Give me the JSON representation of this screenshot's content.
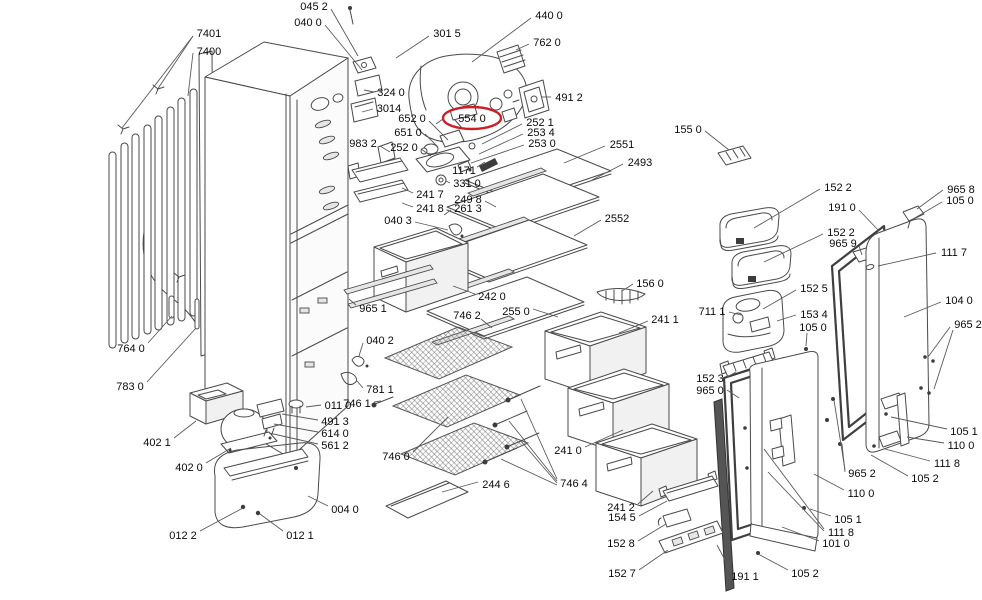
{
  "diagram": {
    "type": "exploded-parts-diagram",
    "background": "#ffffff",
    "line_color": "#4a4a4a",
    "text_color": "#0a0a0a",
    "highlight_color": "#cc2027",
    "selected_part": "554 0",
    "highlight_rx": 29,
    "highlight_ry": 11,
    "labels": [
      {
        "text": "7401",
        "x": 209,
        "y": 33,
        "leaders": [
          [
            193,
            36,
            157,
            90
          ],
          [
            193,
            36,
            122,
            128
          ]
        ]
      },
      {
        "text": "7400",
        "x": 209,
        "y": 51,
        "leaders": [
          [
            193,
            53,
            188,
            96
          ]
        ]
      },
      {
        "text": "045 2",
        "x": 314,
        "y": 6,
        "leaders": [
          [
            331,
            9,
            358,
            56
          ]
        ]
      },
      {
        "text": "040 0",
        "x": 308,
        "y": 22,
        "leaders": [
          [
            325,
            25,
            362,
            70
          ]
        ]
      },
      {
        "text": "301 5",
        "x": 447,
        "y": 33,
        "leaders": [
          [
            429,
            36,
            396,
            58
          ]
        ]
      },
      {
        "text": "440 0",
        "x": 549,
        "y": 15,
        "leaders": [
          [
            531,
            18,
            472,
            62
          ]
        ]
      },
      {
        "text": "762 0",
        "x": 547,
        "y": 42,
        "leaders": [
          [
            529,
            44,
            516,
            50
          ]
        ]
      },
      {
        "text": "324 0",
        "x": 391,
        "y": 92,
        "leaders": [
          [
            374,
            92,
            364,
            90
          ]
        ]
      },
      {
        "text": "3014",
        "x": 389,
        "y": 108,
        "leaders": [
          [
            373,
            109,
            362,
            112
          ]
        ]
      },
      {
        "text": "491 2",
        "x": 569,
        "y": 97,
        "leaders": [
          [
            551,
            97,
            542,
            97
          ]
        ]
      },
      {
        "text": "554 0",
        "x": 472,
        "y": 118,
        "highlight": true,
        "leaders": [
          [
            443,
            119,
            436,
            124
          ]
        ]
      },
      {
        "text": "652 0",
        "x": 412,
        "y": 118,
        "leaders": [
          [
            429,
            121,
            448,
            140
          ]
        ]
      },
      {
        "text": "651 0",
        "x": 408,
        "y": 132,
        "leaders": [
          [
            425,
            134,
            438,
            147
          ]
        ]
      },
      {
        "text": "252 0",
        "x": 404,
        "y": 147,
        "leaders": [
          [
            421,
            149,
            431,
            156
          ]
        ]
      },
      {
        "text": "252 1",
        "x": 540,
        "y": 122,
        "leaders": [
          [
            522,
            124,
            482,
            144
          ]
        ]
      },
      {
        "text": "253 4",
        "x": 541,
        "y": 132,
        "leaders": [
          [
            523,
            134,
            479,
            154
          ]
        ]
      },
      {
        "text": "253 0",
        "x": 542,
        "y": 143,
        "leaders": [
          [
            524,
            145,
            471,
            163
          ]
        ]
      },
      {
        "text": "983 2",
        "x": 363,
        "y": 143,
        "leaders": [
          [
            380,
            146,
            390,
            152
          ]
        ]
      },
      {
        "text": "1171",
        "x": 464,
        "y": 170,
        "leaders": [
          [
            477,
            167,
            485,
            162
          ]
        ]
      },
      {
        "text": "331 0",
        "x": 467,
        "y": 183,
        "leaders": [
          [
            450,
            183,
            446,
            181
          ]
        ]
      },
      {
        "text": "241 7",
        "x": 430,
        "y": 194,
        "leaders": [
          [
            413,
            193,
            402,
            188
          ]
        ]
      },
      {
        "text": "249 8",
        "x": 468,
        "y": 199,
        "leaders": [
          [
            485,
            201,
            496,
            207
          ]
        ]
      },
      {
        "text": "241 8",
        "x": 430,
        "y": 208,
        "leaders": [
          [
            413,
            207,
            402,
            203
          ]
        ]
      },
      {
        "text": "261 3",
        "x": 468,
        "y": 208,
        "leaders": [
          [
            451,
            210,
            444,
            215
          ]
        ]
      },
      {
        "text": "040 3",
        "x": 398,
        "y": 220,
        "leaders": [
          [
            415,
            222,
            448,
            230
          ]
        ]
      },
      {
        "text": "155 0",
        "x": 688,
        "y": 129,
        "leaders": [
          [
            705,
            131,
            729,
            150
          ]
        ]
      },
      {
        "text": "2551",
        "x": 622,
        "y": 144,
        "leaders": [
          [
            605,
            146,
            564,
            163
          ]
        ]
      },
      {
        "text": "2493",
        "x": 640,
        "y": 162,
        "leaders": [
          [
            623,
            164,
            592,
            180
          ]
        ]
      },
      {
        "text": "2552",
        "x": 617,
        "y": 218,
        "leaders": [
          [
            601,
            220,
            574,
            236
          ]
        ]
      },
      {
        "text": "156 0",
        "x": 650,
        "y": 283,
        "leaders": [
          [
            633,
            284,
            622,
            291
          ]
        ]
      },
      {
        "text": "242 0",
        "x": 492,
        "y": 296,
        "leaders": [
          [
            475,
            294,
            453,
            286
          ]
        ]
      },
      {
        "text": "965 1",
        "x": 373,
        "y": 308,
        "leaders": [
          [
            356,
            305,
            349,
            299
          ]
        ]
      },
      {
        "text": "255 0",
        "x": 516,
        "y": 311,
        "leaders": [
          [
            533,
            309,
            558,
            317
          ]
        ]
      },
      {
        "text": "746 2",
        "x": 467,
        "y": 315,
        "leaders": [
          [
            481,
            319,
            492,
            328
          ]
        ]
      },
      {
        "text": "152 2",
        "x": 838,
        "y": 187,
        "leaders": [
          [
            820,
            189,
            754,
            228
          ]
        ]
      },
      {
        "text": "191 0",
        "x": 842,
        "y": 207,
        "leaders": [
          [
            859,
            210,
            879,
            231
          ]
        ]
      },
      {
        "text": "152 2",
        "x": 841,
        "y": 232,
        "leaders": [
          [
            823,
            234,
            764,
            262
          ]
        ]
      },
      {
        "text": "965 9",
        "x": 843,
        "y": 243,
        "leaders": [
          [
            859,
            246,
            862,
            255
          ]
        ]
      },
      {
        "text": "965 8",
        "x": 961,
        "y": 189,
        "leaders": [
          [
            943,
            190,
            917,
            209
          ]
        ]
      },
      {
        "text": "105 0",
        "x": 960,
        "y": 200,
        "leaders": [
          [
            942,
            202,
            913,
            219
          ]
        ]
      },
      {
        "text": "111 7",
        "x": 954,
        "y": 252,
        "leaders": [
          [
            936,
            253,
            878,
            266
          ]
        ]
      },
      {
        "text": "104 0",
        "x": 959,
        "y": 300,
        "leaders": [
          [
            941,
            302,
            904,
            317
          ]
        ]
      },
      {
        "text": "965 2",
        "x": 968,
        "y": 324,
        "leaders": [
          [
            950,
            327,
            928,
            357
          ],
          [
            953,
            330,
            934,
            389
          ]
        ]
      },
      {
        "text": "711 1",
        "x": 712,
        "y": 311,
        "leaders": [
          [
            729,
            312,
            741,
            315
          ]
        ]
      },
      {
        "text": "152 5",
        "x": 814,
        "y": 288,
        "leaders": [
          [
            796,
            290,
            763,
            309
          ]
        ]
      },
      {
        "text": "153 4",
        "x": 814,
        "y": 314,
        "leaders": [
          [
            796,
            315,
            777,
            321
          ]
        ]
      },
      {
        "text": "105 0",
        "x": 813,
        "y": 327,
        "leaders": [
          [
            807,
            333,
            806,
            346
          ]
        ]
      },
      {
        "text": "241 1",
        "x": 665,
        "y": 319,
        "leaders": [
          [
            648,
            321,
            619,
            333
          ]
        ]
      },
      {
        "text": "152 3",
        "x": 710,
        "y": 378,
        "leaders": [
          [
            727,
            377,
            736,
            372
          ]
        ]
      },
      {
        "text": "965 0",
        "x": 710,
        "y": 390,
        "leaders": [
          [
            727,
            390,
            739,
            398
          ]
        ]
      },
      {
        "text": "241 0",
        "x": 568,
        "y": 450,
        "leaders": [
          [
            585,
            447,
            623,
            430
          ]
        ]
      },
      {
        "text": "241 2",
        "x": 621,
        "y": 507,
        "leaders": [
          [
            638,
            504,
            653,
            491
          ]
        ]
      },
      {
        "text": "154 5",
        "x": 622,
        "y": 517,
        "leaders": [
          [
            639,
            516,
            667,
            501
          ]
        ]
      },
      {
        "text": "152 8",
        "x": 621,
        "y": 543,
        "leaders": [
          [
            638,
            541,
            666,
            524
          ]
        ]
      },
      {
        "text": "152 7",
        "x": 622,
        "y": 573,
        "leaders": [
          [
            639,
            570,
            668,
            550
          ]
        ]
      },
      {
        "text": "746 0",
        "x": 396,
        "y": 456,
        "leaders": [
          [
            413,
            452,
            448,
            417
          ]
        ]
      },
      {
        "text": "244 6",
        "x": 496,
        "y": 484,
        "leaders": [
          [
            478,
            482,
            442,
            492
          ]
        ]
      },
      {
        "text": "746 4",
        "x": 574,
        "y": 483,
        "leaders": [
          [
            557,
            479,
            521,
            399
          ],
          [
            557,
            481,
            509,
            421
          ],
          [
            557,
            483,
            520,
            440
          ],
          [
            557,
            485,
            501,
            459
          ]
        ]
      },
      {
        "text": "764 0",
        "x": 131,
        "y": 348,
        "leaders": [
          [
            148,
            343,
            172,
            316
          ]
        ]
      },
      {
        "text": "783 0",
        "x": 130,
        "y": 386,
        "leaders": [
          [
            147,
            382,
            196,
            328
          ]
        ]
      },
      {
        "text": "402 1",
        "x": 157,
        "y": 442,
        "leaders": [
          [
            174,
            438,
            196,
            421
          ]
        ]
      },
      {
        "text": "402 0",
        "x": 189,
        "y": 467,
        "leaders": [
          [
            206,
            463,
            231,
            448
          ]
        ]
      },
      {
        "text": "012 2",
        "x": 183,
        "y": 535,
        "leaders": [
          [
            200,
            531,
            243,
            508
          ]
        ]
      },
      {
        "text": "012 1",
        "x": 300,
        "y": 535,
        "leaders": [
          [
            283,
            531,
            260,
            514
          ]
        ]
      },
      {
        "text": "004 0",
        "x": 345,
        "y": 509,
        "leaders": [
          [
            328,
            506,
            308,
            496
          ]
        ]
      },
      {
        "text": "011 0",
        "x": 338,
        "y": 405,
        "leaders": [
          [
            321,
            405,
            306,
            407
          ]
        ]
      },
      {
        "text": "491 3",
        "x": 335,
        "y": 421,
        "leaders": [
          [
            318,
            420,
            282,
            414
          ]
        ]
      },
      {
        "text": "614 0",
        "x": 335,
        "y": 433,
        "leaders": [
          [
            318,
            432,
            274,
            424
          ]
        ]
      },
      {
        "text": "561 2",
        "x": 335,
        "y": 445,
        "leaders": [
          [
            318,
            444,
            269,
            433
          ]
        ]
      },
      {
        "text": "040 2",
        "x": 380,
        "y": 340,
        "leaders": [
          [
            363,
            343,
            359,
            356
          ]
        ]
      },
      {
        "text": "781 1",
        "x": 380,
        "y": 389,
        "leaders": [
          [
            363,
            388,
            357,
            381
          ]
        ]
      },
      {
        "text": "746 1",
        "x": 357,
        "y": 403,
        "leaders": [
          [
            374,
            402,
            381,
            401
          ]
        ]
      },
      {
        "text": "191 1",
        "x": 745,
        "y": 576,
        "leaders": [
          [
            731,
            571,
            717,
            545
          ]
        ]
      },
      {
        "text": "105 2",
        "x": 805,
        "y": 573,
        "leaders": [
          [
            788,
            570,
            758,
            554
          ]
        ]
      },
      {
        "text": "101 0",
        "x": 836,
        "y": 543,
        "leaders": [
          [
            819,
            541,
            782,
            527
          ]
        ]
      },
      {
        "text": "111 8",
        "x": 841,
        "y": 532,
        "leaders": [
          [
            824,
            529,
            764,
            449
          ],
          [
            824,
            531,
            768,
            472
          ]
        ]
      },
      {
        "text": "105 1",
        "x": 848,
        "y": 519,
        "leaders": [
          [
            831,
            516,
            810,
            509
          ]
        ]
      },
      {
        "text": "110 0",
        "x": 861,
        "y": 493,
        "leaders": [
          [
            844,
            490,
            814,
            474
          ]
        ]
      },
      {
        "text": "965 2",
        "x": 862,
        "y": 473,
        "leaders": [
          [
            845,
            470,
            834,
            400
          ],
          [
            845,
            472,
            842,
            444
          ]
        ]
      },
      {
        "text": "105 1",
        "x": 964,
        "y": 431,
        "leaders": [
          [
            947,
            429,
            891,
            417
          ]
        ]
      },
      {
        "text": "110 0",
        "x": 961,
        "y": 445,
        "leaders": [
          [
            944,
            443,
            907,
            437
          ]
        ]
      },
      {
        "text": "111 8",
        "x": 947,
        "y": 463,
        "leaders": [
          [
            930,
            461,
            885,
            449
          ]
        ]
      },
      {
        "text": "105 2",
        "x": 925,
        "y": 478,
        "leaders": [
          [
            908,
            476,
            871,
            455
          ]
        ]
      }
    ]
  }
}
